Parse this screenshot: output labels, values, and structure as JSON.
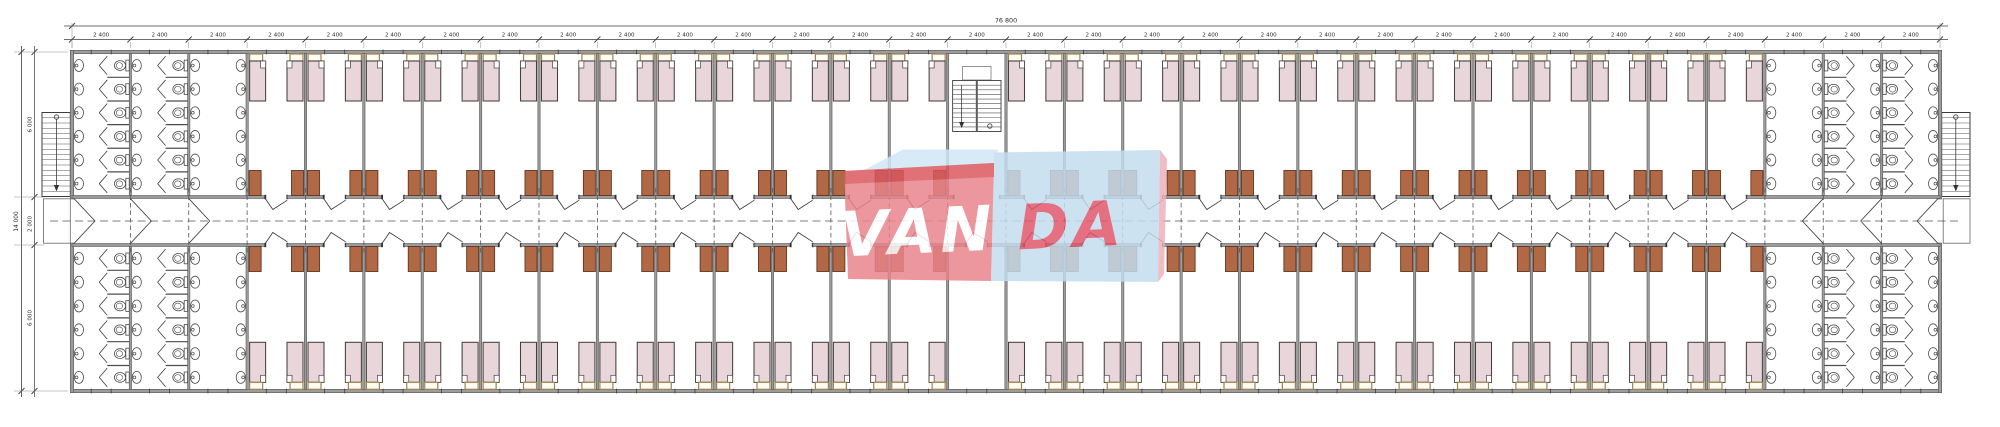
{
  "drawing": {
    "kind": "dormitory-floor-plan",
    "dimensions": {
      "top": {
        "overall_label": "76 800",
        "module_label": "2 400",
        "module_count": 32
      },
      "left": {
        "overall_label": "14 000",
        "segment_labels": [
          "6 000",
          "2 000",
          "6 000"
        ]
      }
    },
    "counts": {
      "top_rooms": 25,
      "bottom_rooms": 26,
      "beds_per_room": 2,
      "wardrobes_per_room": 2,
      "bathroom_modules_per_end": 3,
      "toilets_per_stall_column": 6,
      "sinks_per_column": 6,
      "exterior_stairs": 2,
      "interior_stairs": 1
    },
    "colors": {
      "paper": "#ffffff",
      "line": "#3d3d3d",
      "dim": "#2a2a2a",
      "ext_line": "#8a8a8a",
      "wall_fill": "#9c9c9c",
      "wall_edge": "#4f4f4f",
      "dash": "#555555",
      "bed_fill": "#e9d6da",
      "bed_stroke": "#45403e",
      "locker_stroke": "#a3824c",
      "locker_fill": "#fffdf6",
      "wardrobe_fill": "#b06944",
      "wardrobe_stroke": "#613621",
      "fixture_stroke": "#4a4a4a",
      "fixture_fill": "#ffffff",
      "jamb": "#303030"
    }
  },
  "watermark": {
    "left_text": "VAN",
    "right_text": "DA",
    "left_box_color": "#e9838b",
    "left_box_top_color": "#d9565e",
    "left_flap_color": "#cfe6f6",
    "right_box_color": "#c4ddef",
    "right_flap_color": "#eeb0bb",
    "left_text_color": "#ffffff",
    "right_text_color": "#e0556a",
    "opacity": 0.84
  }
}
